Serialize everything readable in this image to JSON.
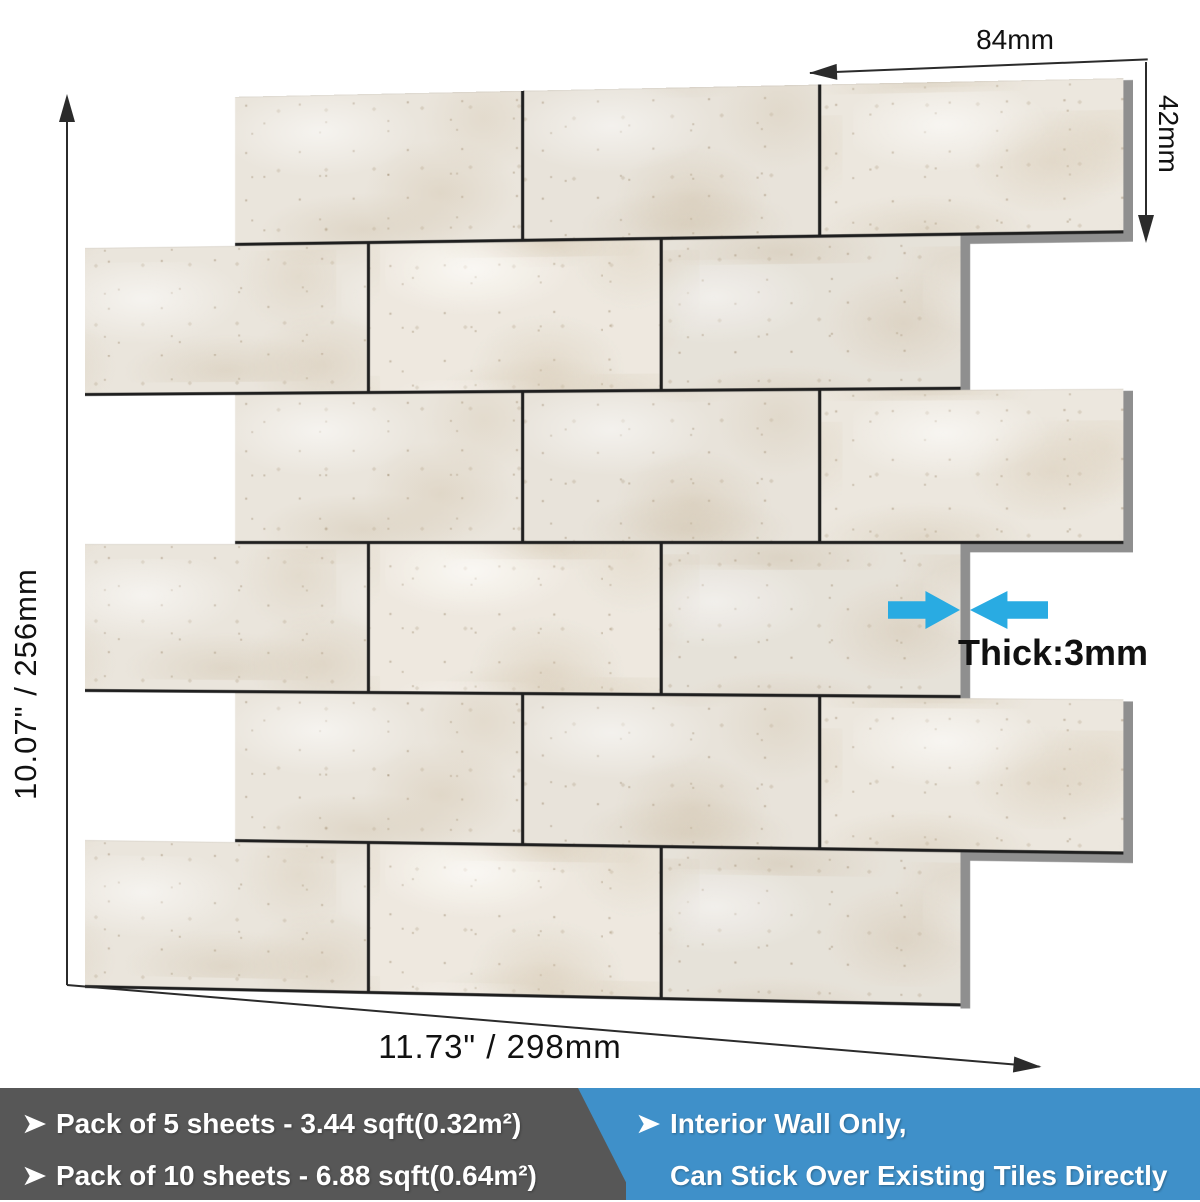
{
  "sheet": {
    "rows": 6,
    "tiles_per_row": 3,
    "pattern": "staggered-subway"
  },
  "annotations": {
    "tile_width": "84mm",
    "tile_height": "42mm",
    "sheet_height": "10.07\" / 256mm",
    "sheet_width": "11.73\" / 298mm",
    "thickness": "Thick:3mm"
  },
  "banners": {
    "gray": {
      "bullet_icon": "black-right-arrowhead",
      "lines": [
        "Pack of 5 sheets - 3.44 sqft(0.32m²)",
        "Pack of 10 sheets - 6.88 sqft(0.64m²)"
      ]
    },
    "blue": {
      "bullet_icon": "black-right-arrowhead",
      "lines": [
        "Interior Wall Only,",
        "Can Stick Over Existing Tiles Directly"
      ]
    }
  },
  "colors": {
    "accent-cyan": "#29abe2",
    "banner-gray": "#575757",
    "banner-blue": "#3f90c9",
    "tile-base": "#eae5dc",
    "grout": "#1f1f1f",
    "edge-gray": "#8f8f8f",
    "dim-line": "#2b2b2b"
  }
}
